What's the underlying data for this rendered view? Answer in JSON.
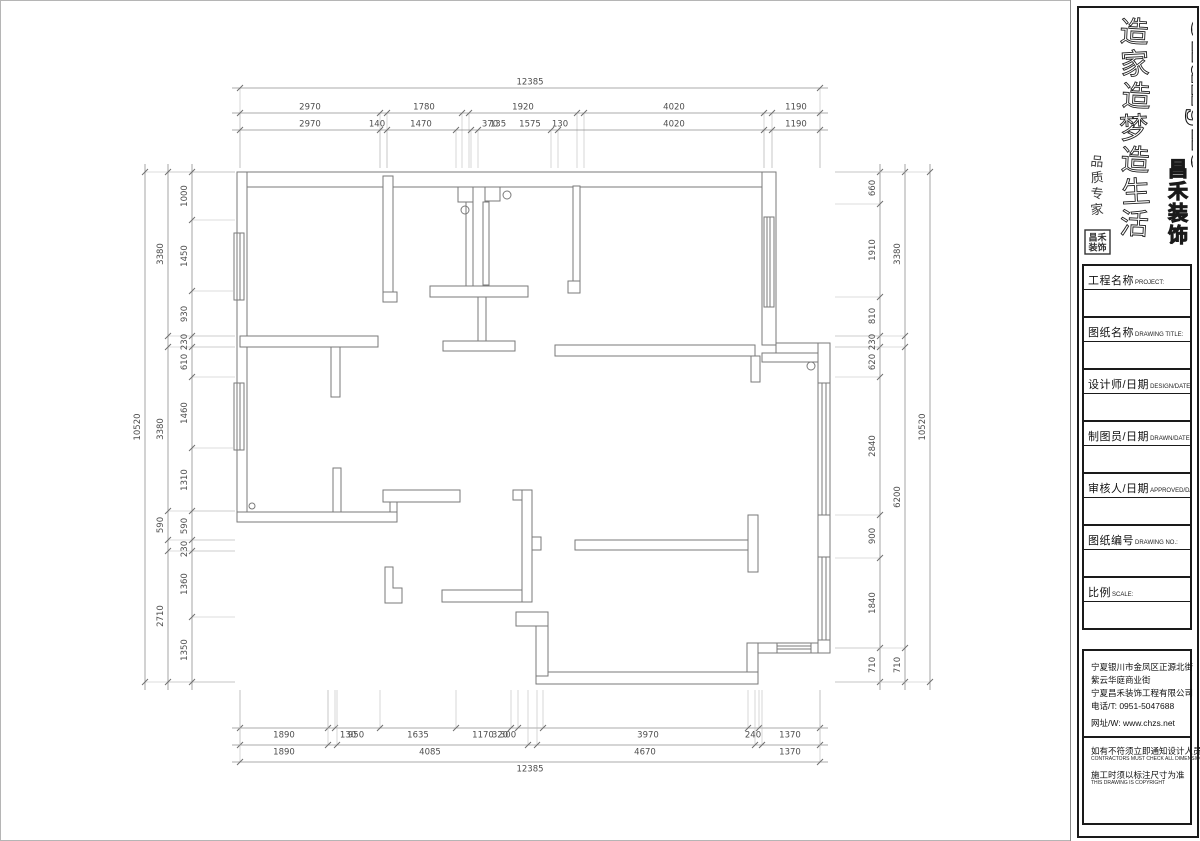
{
  "sheet": {
    "colors": {
      "wall_line": "#7a7a7a",
      "dim_line": "#8f8f8f",
      "ext_line": "#bdbdbd",
      "dim_text": "#4d4d4d",
      "panel_ink": "#1a1a1a"
    }
  },
  "brand": {
    "logo_en": "Changhe",
    "logo_cn_chars": [
      "昌",
      "禾",
      "装",
      "饰"
    ],
    "slogan_chars": [
      "造",
      "家",
      "造",
      "梦",
      "造",
      "生",
      "活"
    ],
    "calligraphy_chars": [
      "品",
      "质",
      "专",
      "家"
    ],
    "seal_line1": "昌禾",
    "seal_line2": "装饰"
  },
  "title_block": {
    "rows": [
      {
        "cn": "工程名称",
        "en": "PROJECT:"
      },
      {
        "cn": "图纸名称",
        "en": "DRAWING TITLE:"
      },
      {
        "cn": "设计师/日期",
        "en": "DESIGN/DATE:"
      },
      {
        "cn": "制图员/日期",
        "en": "DRAWN/DATE:"
      },
      {
        "cn": "审核人/日期",
        "en": "APPROVED/DATE:"
      },
      {
        "cn": "图纸编号",
        "en": "DRAWING NO.:"
      },
      {
        "cn": "比例",
        "en": "SCALE:"
      }
    ]
  },
  "info_block": {
    "address_lines": [
      {
        "text": "宁夏银川市金凤区正源北街",
        "gap": false
      },
      {
        "text": "紫云华庭商业街",
        "gap": false
      },
      {
        "text": "宁夏昌禾装饰工程有限公司",
        "gap": false
      },
      {
        "text": "电话/T: 0951-5047688",
        "gap": false
      },
      {
        "text": "网址/W: www.chzs.net",
        "gap": true
      }
    ],
    "notes": [
      {
        "cn": "如有不符须立即通知设计人员",
        "en": "CONTRACTORS MUST CHECK ALL DIMENSIONS ON SITE"
      },
      {
        "cn": "施工时须以标注尺寸为准",
        "en": "THIS DRAWING IS COPYRIGHT"
      }
    ]
  },
  "dimensions": {
    "plan_bounds": {
      "left": 237,
      "right": 823,
      "top": 172,
      "bottom": 682
    },
    "chains": [
      {
        "o": "h",
        "pos": 88,
        "a": 240,
        "b": 820,
        "ext": 168,
        "ticks": [
          240,
          820
        ],
        "labels": [
          {
            "t": "12385",
            "p": 530
          }
        ]
      },
      {
        "o": "h",
        "pos": 113,
        "a": 240,
        "b": 820,
        "ext": 168,
        "ticks": [
          240,
          380,
          387,
          462,
          469,
          577,
          584,
          764,
          772,
          820
        ],
        "labels": [
          {
            "t": "2970",
            "p": 310
          },
          {
            "t": "1780",
            "p": 424
          },
          {
            "t": "1920",
            "p": 523
          },
          {
            "t": "4020",
            "p": 674
          },
          {
            "t": "1190",
            "p": 796
          }
        ]
      },
      {
        "o": "h",
        "pos": 130,
        "a": 240,
        "b": 820,
        "ext": 168,
        "ticks": [
          240,
          380,
          387,
          456,
          471,
          478,
          551,
          558,
          764,
          772,
          820
        ],
        "labels": [
          {
            "t": "2970",
            "p": 310
          },
          {
            "t": "140",
            "p": 377
          },
          {
            "t": "1470",
            "p": 421
          },
          {
            "t": "370",
            "p": 490
          },
          {
            "t": "135",
            "p": 498
          },
          {
            "t": "1575",
            "p": 530
          },
          {
            "t": "130",
            "p": 560
          },
          {
            "t": "4020",
            "p": 674
          },
          {
            "t": "1190",
            "p": 796
          }
        ]
      },
      {
        "o": "v",
        "pos": 145,
        "a": 172,
        "b": 682,
        "ext": 235,
        "ticks": [
          172,
          682
        ],
        "labels": [
          {
            "t": "10520",
            "p": 427
          }
        ]
      },
      {
        "o": "v",
        "pos": 168,
        "a": 172,
        "b": 682,
        "ext": 235,
        "ticks": [
          172,
          336,
          347,
          511,
          540,
          551,
          682
        ],
        "labels": [
          {
            "t": "3380",
            "p": 254
          },
          {
            "t": "3380",
            "p": 429
          },
          {
            "t": "590",
            "p": 525
          },
          {
            "t": "2710",
            "p": 616
          }
        ]
      },
      {
        "o": "v",
        "pos": 192,
        "a": 172,
        "b": 682,
        "ext": 235,
        "ticks": [
          172,
          220,
          291,
          336,
          347,
          377,
          448,
          511,
          540,
          551,
          617,
          682
        ],
        "labels": [
          {
            "t": "1000",
            "p": 196
          },
          {
            "t": "1450",
            "p": 256
          },
          {
            "t": "930",
            "p": 314
          },
          {
            "t": "230",
            "p": 342
          },
          {
            "t": "610",
            "p": 362
          },
          {
            "t": "1460",
            "p": 413
          },
          {
            "t": "1310",
            "p": 480
          },
          {
            "t": "590",
            "p": 526
          },
          {
            "t": "230",
            "p": 549
          },
          {
            "t": "1360",
            "p": 584
          },
          {
            "t": "1350",
            "p": 650
          }
        ]
      },
      {
        "o": "v",
        "pos": 880,
        "a": 172,
        "b": 682,
        "ext": 835,
        "ticks": [
          172,
          204,
          297,
          336,
          347,
          377,
          515,
          558,
          648,
          682
        ],
        "labels": [
          {
            "t": "660",
            "p": 188
          },
          {
            "t": "1910",
            "p": 250
          },
          {
            "t": "810",
            "p": 316
          },
          {
            "t": "230",
            "p": 342
          },
          {
            "t": "620",
            "p": 362
          },
          {
            "t": "2840",
            "p": 446
          },
          {
            "t": "900",
            "p": 536
          },
          {
            "t": "1840",
            "p": 603
          },
          {
            "t": "710",
            "p": 665
          }
        ]
      },
      {
        "o": "v",
        "pos": 905,
        "a": 172,
        "b": 682,
        "ext": 835,
        "ticks": [
          172,
          336,
          347,
          648,
          682
        ],
        "labels": [
          {
            "t": "3380",
            "p": 254
          },
          {
            "t": "6200",
            "p": 497
          },
          {
            "t": "710",
            "p": 665
          }
        ]
      },
      {
        "o": "v",
        "pos": 930,
        "a": 172,
        "b": 682,
        "ext": 835,
        "ticks": [
          172,
          682
        ],
        "labels": [
          {
            "t": "10520",
            "p": 427
          }
        ]
      },
      {
        "o": "h",
        "pos": 728,
        "a": 240,
        "b": 820,
        "ext": 690,
        "ticks": [
          240,
          328,
          335,
          380,
          456,
          511,
          518,
          543,
          748,
          759,
          820
        ],
        "labels": [
          {
            "t": "1890",
            "p": 284
          },
          {
            "t": "130",
            "p": 348
          },
          {
            "t": "950",
            "p": 356
          },
          {
            "t": "1635",
            "p": 418
          },
          {
            "t": "1170",
            "p": 483
          },
          {
            "t": "320",
            "p": 500
          },
          {
            "t": "300",
            "p": 508
          },
          {
            "t": "3970",
            "p": 648
          },
          {
            "t": "240",
            "p": 753
          },
          {
            "t": "1370",
            "p": 790
          }
        ]
      },
      {
        "o": "h",
        "pos": 745,
        "a": 240,
        "b": 820,
        "ext": 690,
        "ticks": [
          240,
          328,
          337,
          528,
          537,
          755,
          762,
          820
        ],
        "labels": [
          {
            "t": "1890",
            "p": 284
          },
          {
            "t": "4085",
            "p": 430
          },
          {
            "t": "4670",
            "p": 645
          },
          {
            "t": "1370",
            "p": 790
          }
        ]
      },
      {
        "o": "h",
        "pos": 762,
        "a": 240,
        "b": 820,
        "ext": 690,
        "ticks": [
          240,
          820
        ],
        "labels": [
          {
            "t": "12385",
            "p": 530
          }
        ]
      }
    ]
  }
}
